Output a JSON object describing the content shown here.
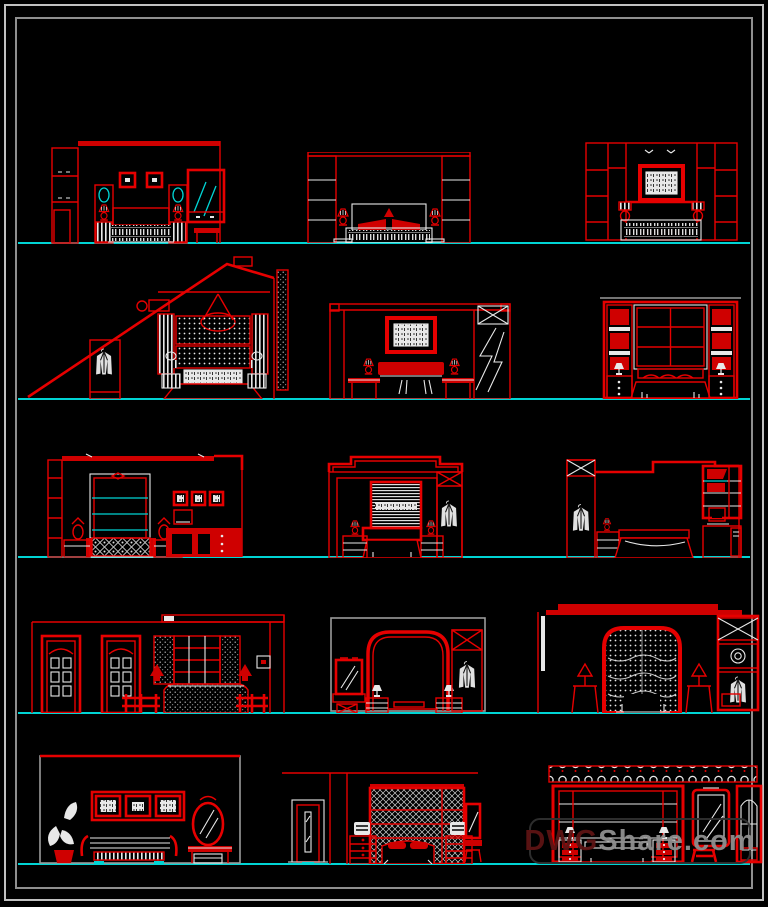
{
  "sheet": {
    "kind": "cad-elevation-sheet",
    "description": "AutoCAD bedroom interior elevation drawings, red/white/cyan lines on black",
    "rows": 5,
    "floor_line_y": [
      242,
      398,
      556,
      712,
      863
    ]
  },
  "colors": {
    "red": "#e60000",
    "red_fill": "#cf0000",
    "white": "#e8e8e8",
    "cyan": "#00d4d4",
    "border_outer": "#c0c0c0",
    "border_inner": "#8f8f8f",
    "background": "#000000",
    "watermark_gray": "#8f8f8f",
    "watermark_red": "#5d1414"
  },
  "watermark": {
    "prefix": "DWG",
    "suffix": "Share.com"
  },
  "drawings": [
    {
      "id": "r1c1",
      "name": "bedroom-wall-wardrobe-bed-vanity"
    },
    {
      "id": "r1c2",
      "name": "bed-wall-symmetric-shelves"
    },
    {
      "id": "r1c3",
      "name": "bed-wall-center-picture-frame"
    },
    {
      "id": "r2c1",
      "name": "attic-bedroom-section"
    },
    {
      "id": "r2c2",
      "name": "bed-wall-framed-art"
    },
    {
      "id": "r2c3",
      "name": "bed-wall-cabinet-grid"
    },
    {
      "id": "r3c1",
      "name": "headboard-shelf-desk-wall"
    },
    {
      "id": "r3c2",
      "name": "bed-alcove-window-blinds"
    },
    {
      "id": "r3c3",
      "name": "wardrobe-desk-bedroom-wall"
    },
    {
      "id": "r4c1",
      "name": "double-doors-shelving-bed-wall"
    },
    {
      "id": "r4c2",
      "name": "arched-bed-alcove-mirror"
    },
    {
      "id": "r4c3",
      "name": "arched-curtain-headboard-wall"
    },
    {
      "id": "r5c1",
      "name": "console-bench-oval-mirror-wall"
    },
    {
      "id": "r5c2",
      "name": "door-curtain-bed-wall"
    },
    {
      "id": "r5c3",
      "name": "shelving-mirror-cabinet-wall"
    }
  ]
}
